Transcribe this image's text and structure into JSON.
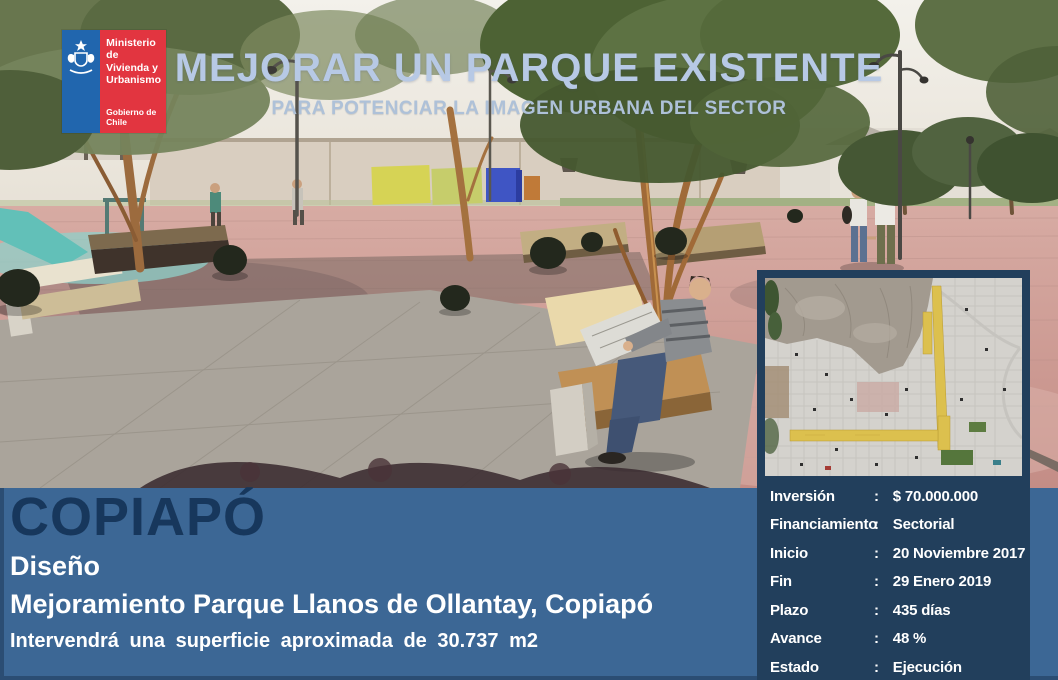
{
  "logo": {
    "ministry": "Ministerio de\nVivienda y\nUrbanismo",
    "government": "Gobierno de Chile"
  },
  "header": {
    "title": "MEJORAR UN PARQUE EXISTENTE",
    "subtitle": "PARA POTENCIAR LA IMAGEN URBANA DEL SECTOR"
  },
  "project": {
    "city": "COPIAPÓ",
    "stage": "Diseño",
    "name": "Mejoramiento Parque Llanos de Ollantay, Copiapó",
    "surface_note": "Intervendrá una superficie aproximada de 30.737 m2"
  },
  "info": {
    "separator": ":",
    "rows": [
      {
        "label": "Inversión",
        "value": "$ 70.000.000"
      },
      {
        "label": "Financiamiento",
        "value": "Sectorial"
      },
      {
        "label": "Inicio",
        "value": "20 Noviembre 2017"
      },
      {
        "label": "Fin",
        "value": "29 Enero 2019"
      },
      {
        "label": "Plazo",
        "value": "435 días"
      },
      {
        "label": "Avance",
        "value": "48 %"
      },
      {
        "label": "Estado",
        "value": "Ejecución"
      }
    ]
  },
  "colors": {
    "steel_panel": "#3c6795",
    "navy_panel": "#223f5c",
    "city_text": "#17375c",
    "title_text": "#b7c9e5",
    "logo_blue": "#2166ae",
    "logo_red": "#e23540",
    "map_highlight_yellow": "#dcc04e"
  }
}
